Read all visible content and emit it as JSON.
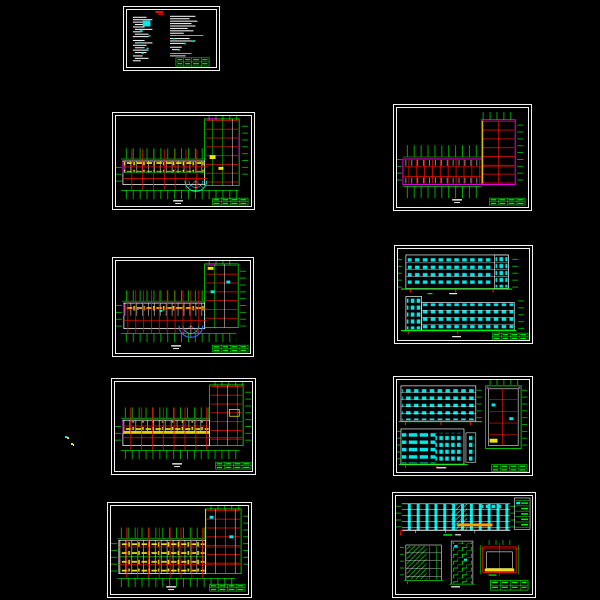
{
  "canvas": {
    "width": 600,
    "height": 600,
    "background": "#000000",
    "description": "CAD architectural drawing set preview, nine sheets on black model space"
  },
  "palette": {
    "bg": "#000000",
    "line_white": "#f2f2f2",
    "line_green": "#00f000",
    "line_red": "#e81000",
    "line_cyan": "#00e8e8",
    "line_yellow": "#f2e400",
    "line_magenta": "#f000f0",
    "line_orange": "#ff9f00",
    "line_blue": "#3a6cff"
  },
  "sheets": [
    {
      "id": "sheet-1",
      "name": "general-notes-sheet",
      "kind": "notes",
      "features": "two columns of specification text, red logo mark, cyan highlights, green title block"
    },
    {
      "id": "sheet-2",
      "name": "floor-plan-1",
      "kind": "floor-plan",
      "features": "L-shaped plan, red column grid, green dimension ticks, yellow room fittings, cyan entrance arc, title block"
    },
    {
      "id": "sheet-3",
      "name": "floor-plan-2",
      "kind": "floor-plan",
      "features": "L-shaped plan with magenta outline, dense red grid, green dimension ticks, title block"
    },
    {
      "id": "sheet-4",
      "name": "floor-plan-3",
      "kind": "floor-plan",
      "features": "L-shaped plan, red grid, yellow fittings, blue-cyan entrance arc, title block"
    },
    {
      "id": "sheet-5",
      "name": "elevations-1",
      "kind": "elevations",
      "features": "two long elevations with cyan window grids, green ground lines, red level ticks, title block"
    },
    {
      "id": "sheet-6",
      "name": "floor-plan-4",
      "kind": "floor-plan",
      "features": "L-shaped plan, yellow corridor band, red grid, green dimension ticks, title block"
    },
    {
      "id": "sheet-7",
      "name": "elevations-and-stair-wing-plan",
      "kind": "elevations-detail",
      "features": "two cyan-window elevations, stair window column, wing plan detail with red grid, title block"
    },
    {
      "id": "sheet-8",
      "name": "floor-plan-5",
      "kind": "floor-plan",
      "features": "L-shaped plan, double room rows with yellow fittings, red grid, title block"
    },
    {
      "id": "sheet-9",
      "name": "section-and-details",
      "kind": "section-details",
      "features": "long building section with cyan columns and orange beam, green hatched detail, stair section, red detail plan, title block"
    }
  ],
  "stray_marks": {
    "count": 2,
    "description": "tiny cyan/yellow stray pixels left of plan sheet 4"
  }
}
